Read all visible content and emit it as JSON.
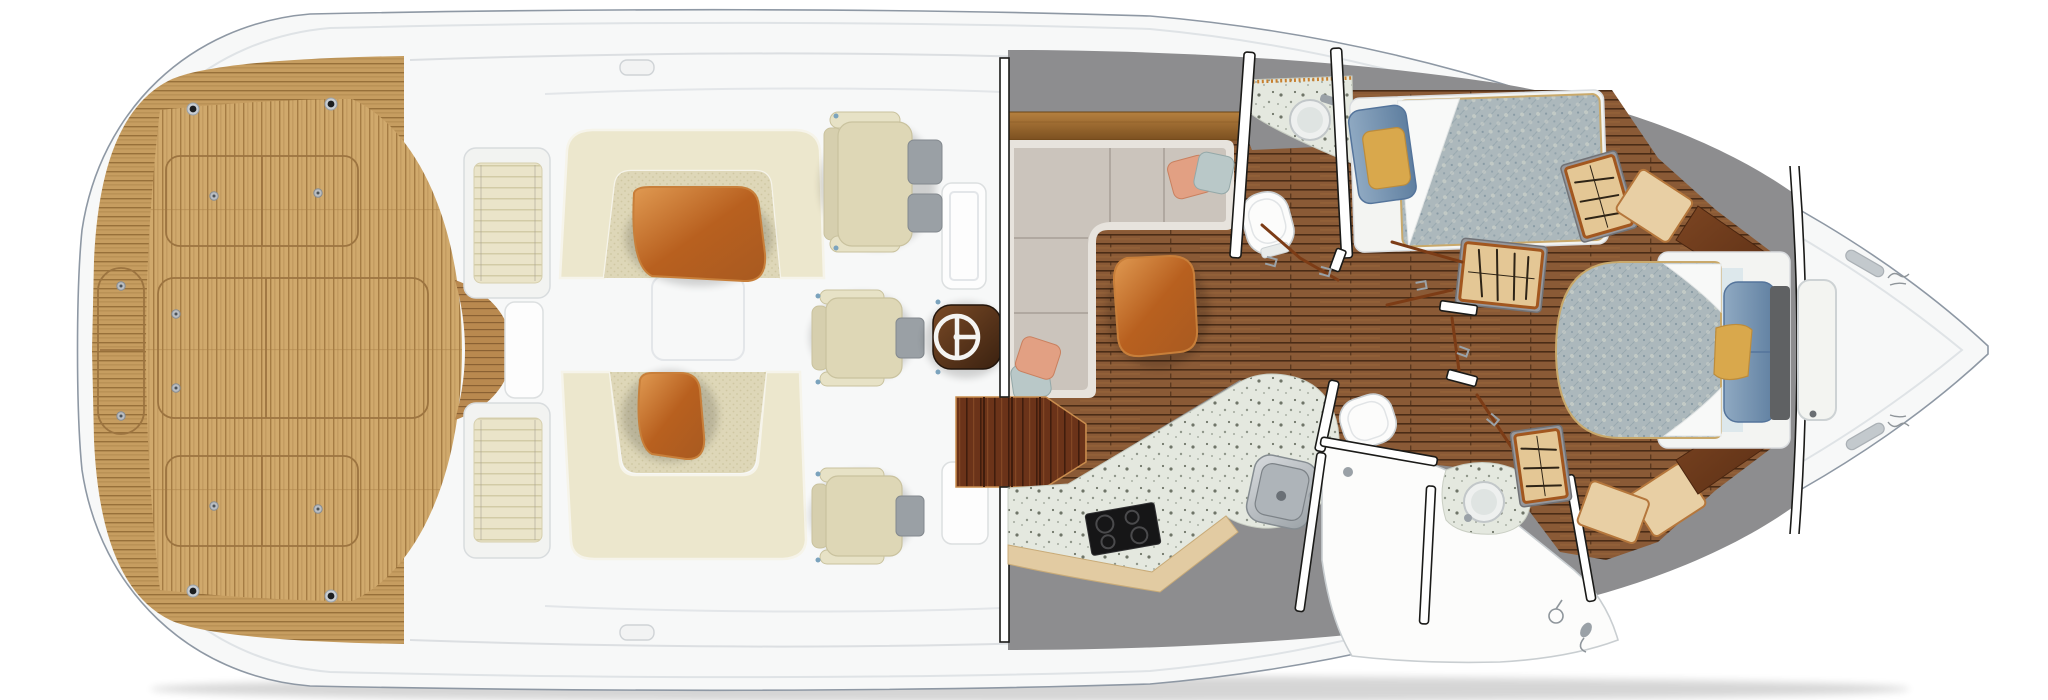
{
  "palette": {
    "page_bg": "#ffffff",
    "hull_white": "#f7f8f8",
    "hull_line": "#8e98a4",
    "rub_line": "#dfe3e6",
    "deck_line": "#dcdfe2",
    "teak_sole": "#d0a96c",
    "teak_sole_line": "#a57c44",
    "gunwale": "#c69d60",
    "gunwale_line": "#97703a",
    "walkway": "#b9894f",
    "walkway_line": "#8a6133",
    "hatch_line": "#9c7440",
    "screw": "#b9bdc2",
    "rodholder": "#1c1e20",
    "bench_frame": "#f2f3f1",
    "cushion_cream": "#eae4c9",
    "cushion_line": "#d2cba6",
    "lounge_back": "#ece7cd",
    "lounge_edge": "#f6f4ea",
    "seat_tex": "#ded7b8",
    "seat_dot": "#cfc7a2",
    "table_wood_1": "#b8601f",
    "table_wood_2": "#e09a52",
    "table_wood_3": "#a85a20",
    "table_rim": "#c87f3a",
    "chair_cream": "#ded7b6",
    "chair_trim": "#c9c29e",
    "chair_arm": "#e7e2c6",
    "chair_back": "#d6cfae",
    "equip_gray": "#9aa0a5",
    "console_wood_1": "#7a4a26",
    "console_wood_2": "#3a2110",
    "wheel_white": "#f4f4f2",
    "wall_gray": "#8d8d8f",
    "shelf_1": "#b5803f",
    "shelf_2": "#7c5020",
    "sofa_gray": "#cbc4bc",
    "sofa_line": "#a79f96",
    "sofa_edge": "#e7e3dd",
    "pillow_salmon": "#e2a083",
    "pillow_blue": "#b9c8c8",
    "floor_plank": "#8a5a36",
    "floor_line": "#4a2c16",
    "floor_streak": "#a5713f",
    "step_wood": "#6b3319",
    "step_dark": "#401d0d",
    "step_streak": "#8a4c27",
    "step_edge": "#c98d4e",
    "counter_speckle": "#e4e8df",
    "speck_1": "#6f7568",
    "speck_2": "#8f968a",
    "speck_3": "#aab1a5",
    "bead_orange": "#c8802f",
    "bar_tan": "#e2cba2",
    "steel_1": "#d7dadd",
    "steel_2": "#9ba2a7",
    "steel_mid": "#aeb4b9",
    "steel_line": "#7c8287",
    "fixture_white": "#fcfcfb",
    "fixture_line": "#c9ced1",
    "quilt_base": "#acb8bc",
    "quilt_line": "#97a7ae",
    "quilt_light": "#c9cfc9",
    "quilt_dark": "#7e929e",
    "sheet_white": "#f8f9f8",
    "berth_base": "#f3f4f2",
    "bed_rim": "#c9a96b",
    "pillow_navy_1": "#8fa9c2",
    "pillow_navy_2": "#5f7fa0",
    "pillow_navy_line": "#54749b",
    "pillow_gold": "#d9a84c",
    "pillow_gold_line": "#bc8c3c",
    "locker_gray": "#97989c",
    "locker_tan": "#e4c795",
    "locker_frame": "#a2571f",
    "hanger_dark": "#2e2416",
    "cab_tan": "#e8cfa4",
    "cab_tan_line": "#b5773c",
    "wood_wedge_1": "#7c4522",
    "wood_wedge_2": "#5a2e14",
    "headboard": "#5f6163",
    "frame_black": "#1a1a18",
    "frame_white": "#ffffff",
    "door_swing": "#7c3c16",
    "bracket_gray": "#9aa2a8",
    "hinge_blue": "#7ba3bd",
    "rail_gray": "#c3c9cd",
    "rail_line": "#aab0b5",
    "script_gray": "#8f959a"
  },
  "icons": {
    "steering-wheel-icon": "white ring with spokes on wood pod",
    "cooktop-icon": "black square with 4 burner rings",
    "sink-icon": "round or square basin with faucet",
    "toilet-icon": "white oval bowl with lid",
    "shower-icon": "mixer dial and hand-shower wand",
    "hanger-icon": "dark zigzag clothes strokes in tan locker",
    "screw-icon": "small gray circle with center dot",
    "rod-holder-icon": "black dot with gray ring",
    "cleat-icon": "small rounded white handle",
    "handrail-icon": "elongated gray pill",
    "brand-script-icon": "tiny gray cursive squiggle"
  }
}
